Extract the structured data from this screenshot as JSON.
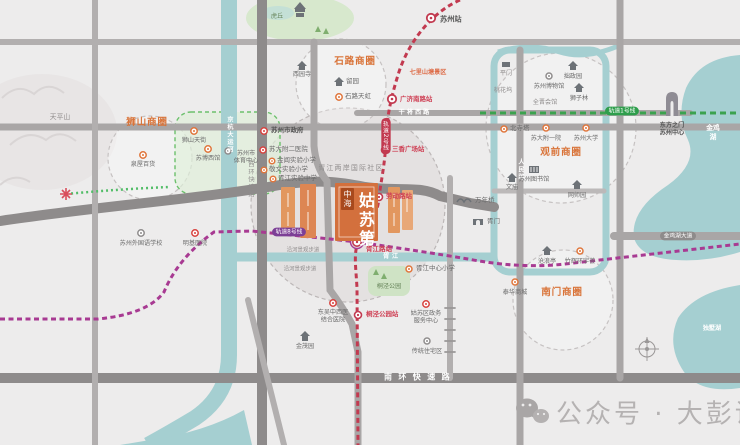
{
  "watermark": {
    "text": "公众号 · 大彭说房"
  },
  "project": {
    "developer": "中海",
    "name": "姑苏第",
    "area_label": "胥江两岸国际社区"
  },
  "business_circles": {
    "shishan": "狮山商圈",
    "shilu": "石路商圈",
    "guanqian": "观前商圈",
    "nanmen": "南门商圈"
  },
  "metro": {
    "line1_label": "轨道1号线",
    "line2_label": "轨道2号线",
    "line8_label": "轨道8号线",
    "line1_color": "#3ba24e",
    "line2_color": "#c23a50",
    "line8_color": "#a83a92",
    "stations": {
      "suzhou": "苏州站",
      "guangji_nanlu": "广济南路站",
      "sanxiang_guangchang": "三香广场站",
      "laodong_lu": "劳动路站",
      "xujiang_lu": "胥江路站",
      "tongjing_gongyuan": "桐泾公园站"
    }
  },
  "roads": {
    "nanhuan": "南环快速路",
    "xihuan": "西环快速路",
    "ganjiang": "干将西路",
    "renmin": "人民路",
    "jinjihu": "金鸡湖大道"
  },
  "waters": {
    "canal": "京杭大运河",
    "xujiang": "胥江",
    "jinjihu_lake": "金鸡湖",
    "dushuhu_lake": "独墅湖",
    "walkway": "沿河景观步道"
  },
  "nature": {
    "tianpingshan": "天平山",
    "huqiu": "虎丘",
    "tongjing_park": "桐泾公园"
  },
  "pois": {
    "shishan_tianjie": "狮山天街",
    "quanwu_baihuo": "泉屋百货",
    "subo_xiguan": "苏博西馆",
    "sports_center": "苏州市\n体育中心",
    "xiyuan_si": "西园寺",
    "liu_yuan": "留园",
    "shilu_tianhong": "石路天虹",
    "qili_shantang": "七里山塘景区",
    "shizhengfu": "苏州市政府",
    "suda_fuer": "苏大附二医院",
    "jinchang_xiaoxue": "金阊实验小学",
    "jingwen_xiaoxue": "敬文实验小学",
    "xujiang_zhongxue": "胥江实验中学",
    "suzhou_waiguoyu": "苏州外国语学校",
    "mingji_yiyuan": "明基医院",
    "pingmen": "平门",
    "taohuawu": "桃花坞",
    "zhuozheng_yuan": "拙政园",
    "suzhou_bowuguan": "苏州博物馆",
    "shizilin": "狮子林",
    "quanjin_huiguan": "全晋会馆",
    "beisita": "北寺塔",
    "suda_fuyi": "苏大附一院",
    "suzhou_daxue": "苏州大学",
    "suzhou_tushuguan": "苏州图书馆",
    "wenmiao": "文庙",
    "wangshi_yuan": "网师园",
    "canglang_ting": "沧浪亭",
    "zhuhui_huanyuhui": "竹辉环宇荟",
    "taihua_shangcheng": "泰华商城",
    "dongfangzhimen": "东方之门\n苏州中心",
    "wannian_qiao": "万年桥",
    "xumen": "胥门",
    "xujiang_zhongxin_xiaoxue": "胥江中心小学",
    "dongwu_yiyuan": "东吴中西医\n结合医院",
    "jinmao_yuan": "金茂园",
    "gusu_zhengwu": "姑苏区政务\n服务中心",
    "chuantong_zhuzhai": "传统住宅区"
  },
  "colors": {
    "background": "#edecec",
    "water": "#a5cfd1",
    "park": "#d7e8cd",
    "road_major": "#8e8b8b",
    "road_minor": "#b2afaf",
    "project_orange": "#d3703d",
    "brand_orange": "#d97338",
    "watermark_gray": "#b5b2b2"
  }
}
